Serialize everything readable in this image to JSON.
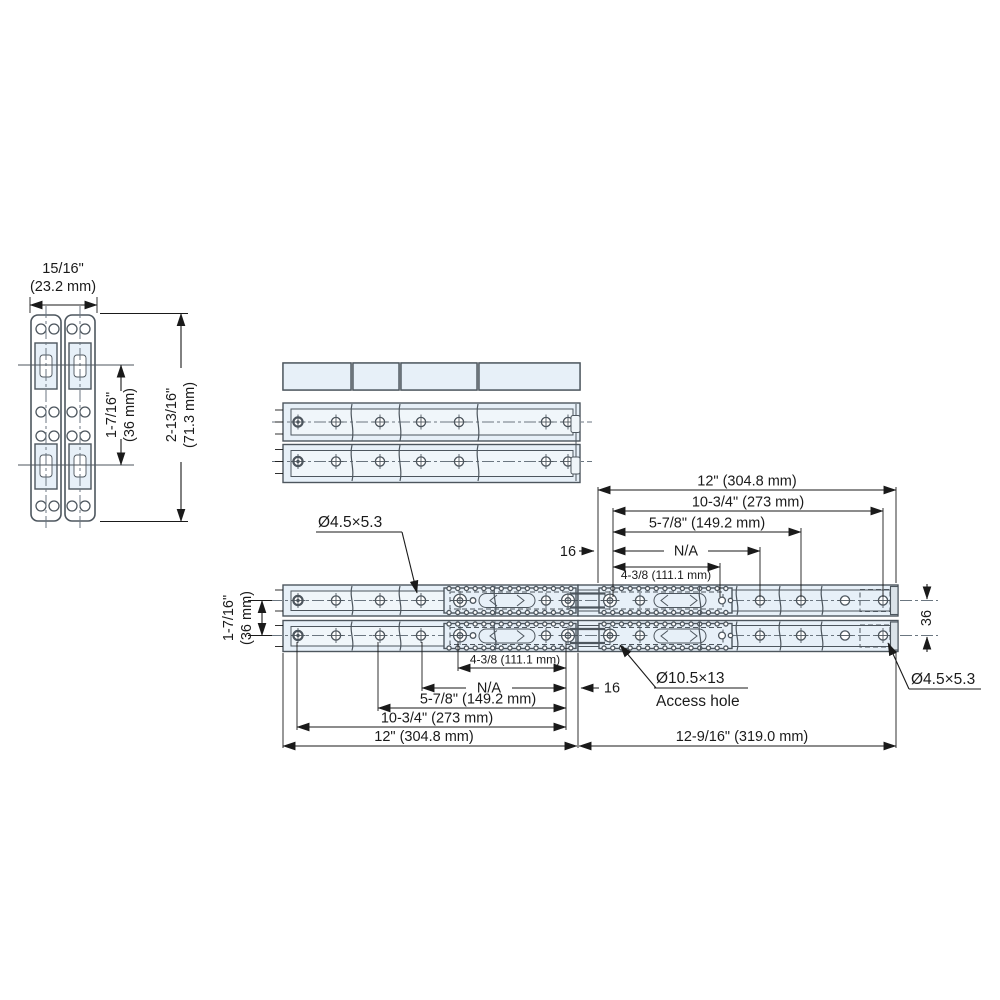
{
  "views": {
    "cross_section": {
      "width_in": "15/16\"",
      "width_mm": "(23.2 mm)",
      "row_spacing_in": "1-7/16\"",
      "row_spacing_mm": "(36 mm)",
      "height_in": "2-13/16\"",
      "height_mm": "(71.3 mm)"
    },
    "extended": {
      "dims_top": {
        "overall": "12\" (304.8 mm)",
        "d273": "10-3/4\" (273 mm)",
        "d149": "5-7/8\" (149.2 mm)",
        "na": "N/A",
        "d111": "4-3/8 (111.1 mm)",
        "end_offset": "16"
      },
      "dims_bottom": {
        "d111": "4-3/8 (111.1 mm)",
        "na": "N/A",
        "end_offset": "16",
        "d149": "5-7/8\" (149.2 mm)",
        "d273": "10-3/4\" (273 mm)",
        "overall": "12\" (304.8 mm)",
        "extension": "12-9/16\" (319.0 mm)"
      },
      "dims_side": {
        "left_in": "1-7/16\"",
        "left_mm": "(36 mm)",
        "right_mm": "36"
      },
      "callouts": {
        "screw_hole_top": "Ø4.5×5.3",
        "screw_hole_right": "Ø4.5×5.3",
        "access_hole_dia": "Ø10.5×13",
        "access_hole_label": "Access hole"
      }
    }
  },
  "colors": {
    "fill": "#e7f0f8",
    "fill_light": "#f0f6fa",
    "line": "#4d565e",
    "dim": "#1a1a1a",
    "end_cap": "#dbe3e9"
  }
}
